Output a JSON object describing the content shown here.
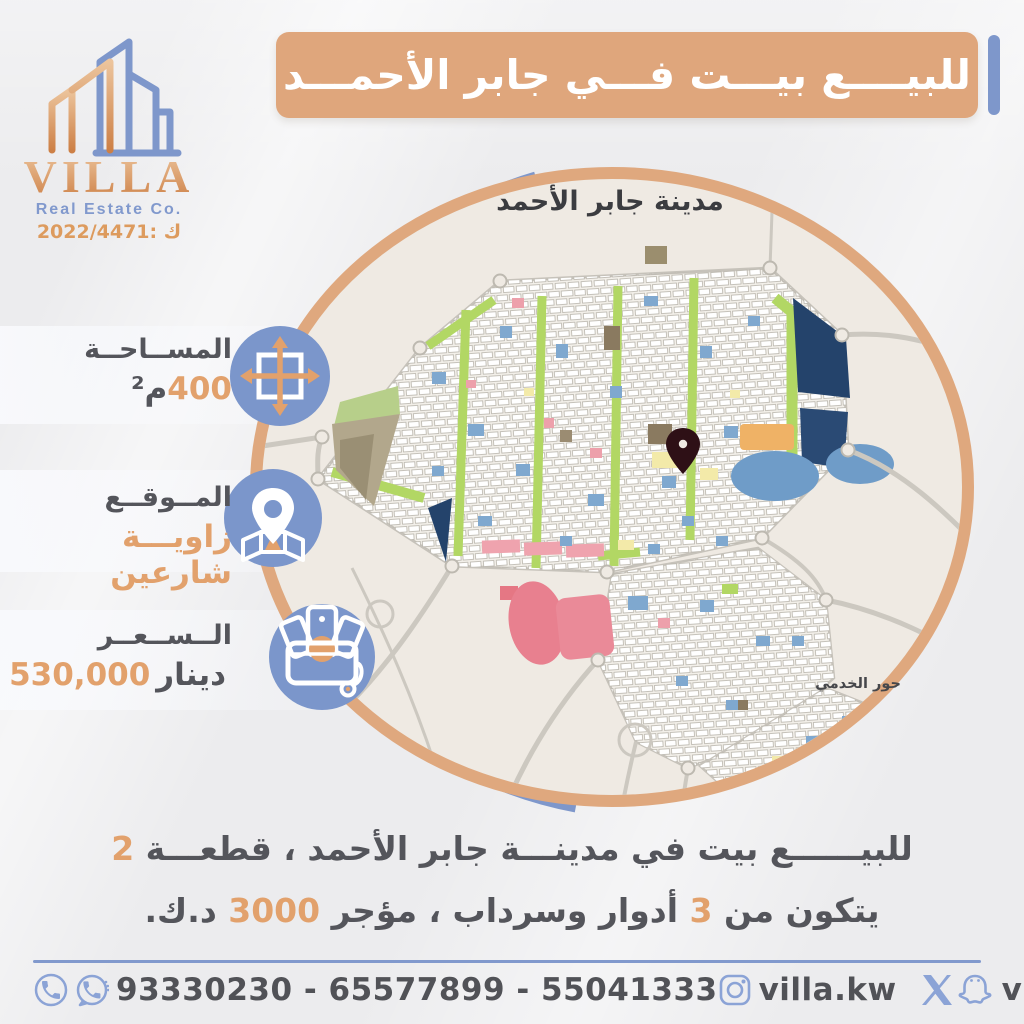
{
  "brand": {
    "name": "VILLA",
    "tagline": "Real Estate Co.",
    "license": "2022/4471: ك"
  },
  "header": {
    "title": "للبيــــع بيـــت فـــي جابر الأحمـــد"
  },
  "map": {
    "title": "مدينة جابر الأحمد",
    "district_label": "حور الخدمي"
  },
  "info": {
    "area": {
      "label": "المســاحــة",
      "value": "400",
      "unit": "م²"
    },
    "location": {
      "label": "المــوقــع",
      "value": "زاويـــة شارعين"
    },
    "price": {
      "label": "الــســعــر",
      "value": "530,000",
      "unit": "دينار"
    }
  },
  "description": {
    "line1_parts": [
      {
        "text": "للبيــــــع بيت في مدينـــة جابر الأحمد ، قطعـــة ",
        "tone": "dark"
      },
      {
        "text": "2",
        "tone": "orange"
      }
    ],
    "line2_parts": [
      {
        "text": "يتكون من ",
        "tone": "dark"
      },
      {
        "text": "3",
        "tone": "orange"
      },
      {
        "text": " أدوار وسرداب ، مؤجر ",
        "tone": "dark"
      },
      {
        "text": "3000",
        "tone": "orange"
      },
      {
        "text": " د.ك.",
        "tone": "dark"
      }
    ]
  },
  "footer": {
    "phones": "93330230 - 65577899 - 55041333",
    "instagram_handle": "villa.kw",
    "social_handle": "villa_kw"
  },
  "colors": {
    "accent_orange": "#dfa87e",
    "accent_blue": "#7e97cb",
    "text_dark": "#55565c",
    "number_orange": "#e2a16c",
    "map_navy": "#24436b",
    "map_green": "#b2d764",
    "map_pink": "#e8808f",
    "map_water_blue": "#6f9cc8",
    "map_bg": "#efeae3"
  }
}
